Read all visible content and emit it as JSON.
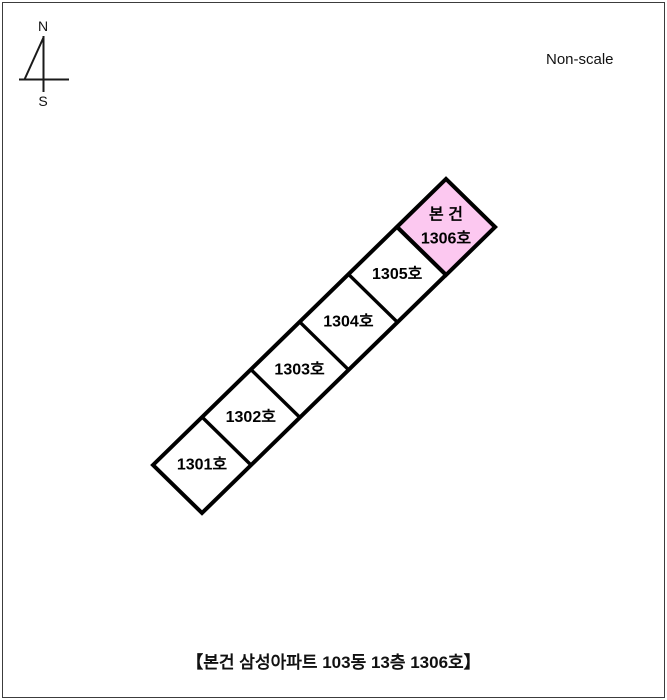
{
  "compass": {
    "north_label": "N",
    "south_label": "S"
  },
  "scale_note": "Non-scale",
  "diagram": {
    "units": [
      {
        "label": "1301호",
        "highlighted": false
      },
      {
        "label": "1302호",
        "highlighted": false
      },
      {
        "label": "1303호",
        "highlighted": false
      },
      {
        "label": "1304호",
        "highlighted": false
      },
      {
        "label": "1305호",
        "highlighted": false
      },
      {
        "label": "1306호",
        "prefix": "본 건",
        "highlighted": true
      }
    ],
    "highlight_color": "#fcc8f0",
    "line_color": "#000000",
    "label_color": "#000000",
    "fill_color": "#ffffff"
  },
  "caption": "【본건 삼성아파트 103동 13층 1306호】"
}
